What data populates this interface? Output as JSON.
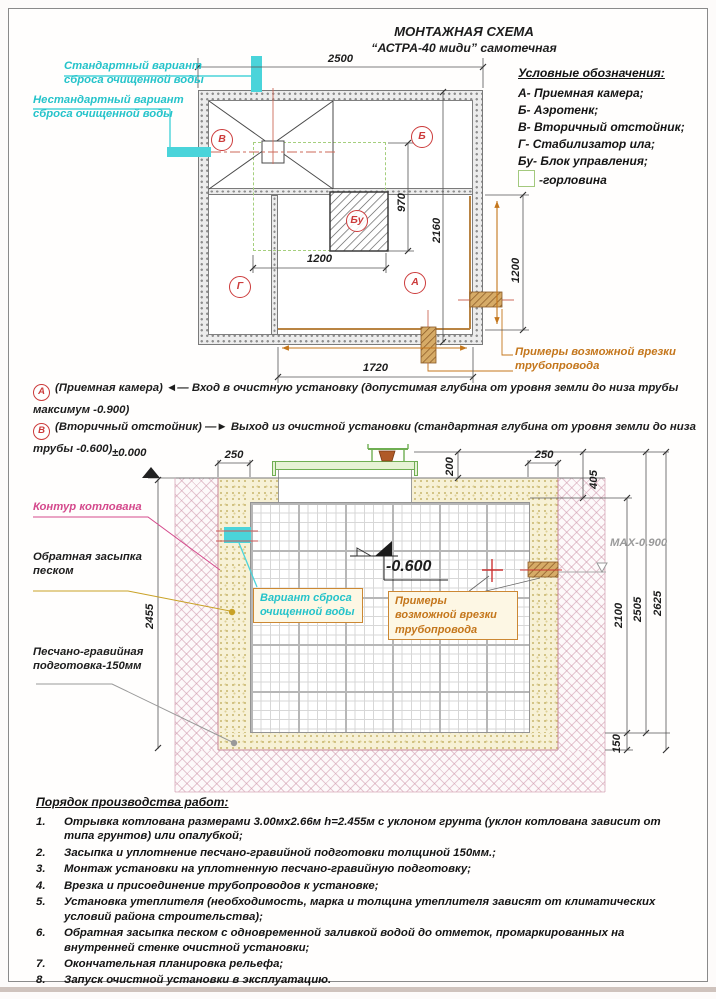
{
  "page": {
    "title_line1": "МОНТАЖНАЯ СХЕМА",
    "title_line2": "“АСТРА-40 миди” самотечная"
  },
  "legend": {
    "title": "Условные обозначения:",
    "items": [
      {
        "key": "А-",
        "label": "Приемная камера;"
      },
      {
        "key": "Б-",
        "label": "Аэротенк;"
      },
      {
        "key": "В-",
        "label": "Вторичный отстойник;"
      },
      {
        "key": "Г-",
        "label": "Стабилизатор ила;"
      },
      {
        "key": "Бу-",
        "label": "Блок управления;"
      }
    ],
    "neck": "-горловина"
  },
  "plan": {
    "discharge_standard": "Стандартный вариант сброса очищенной воды",
    "discharge_nonstandard": "Нестандартный вариант сброса очищенной воды",
    "pipe_examples": "Примеры возможной врезки трубопровода",
    "markers": {
      "v": "В",
      "b": "Б",
      "bu": "Бу",
      "g": "Г",
      "a": "А"
    },
    "dims": {
      "top_width": "2500",
      "right_height": "2160",
      "bu_width": "1200",
      "bu_height": "970",
      "bottom": "1720",
      "right_inlet": "1200"
    }
  },
  "notes": {
    "a": {
      "marker": "А",
      "name": "(Приемная камера)",
      "arrow": "◄—",
      "text": "Вход в очистную установку (допустимая глубина от уровня земли до низа трубы",
      "text2": "максимум -0.900)"
    },
    "b": {
      "marker": "В",
      "name": "(Вторичный отстойник)",
      "arrow": "—►",
      "text": "Выход из очистной установки (стандартная глубина от уровня земли до низа",
      "text2": "трубы -0.600)"
    }
  },
  "section": {
    "levels": {
      "zero": "±0.000",
      "minus600": "-0.600",
      "max900": "MAX-0.900"
    },
    "dims": {
      "backfill_left": "250",
      "lid": "200",
      "backfill_right": "250",
      "top": "405",
      "body": "2100",
      "mid": "2505",
      "total": "2625",
      "bed": "150",
      "depth": "2455"
    },
    "labels": {
      "contour": "Контур котлована",
      "backfill": "Обратная засыпка песком",
      "discharge_variant": "Вариант сброса очищенной воды",
      "pipe_examples": "Примеры возможной врезки трубопровода",
      "bed": "Песчано-гравийная подготовка-150мм"
    }
  },
  "procedure": {
    "title": "Порядок производства работ:",
    "items": [
      {
        "num": "1.",
        "text": "Отрывка котлована размерами 3.00мх2.66м h=2.455м с уклоном грунта (уклон котлована зависит от типа грунтов) или опалубкой;"
      },
      {
        "num": "2.",
        "text": "Засыпка и уплотнение песчано-гравийной подготовки толщиной 150мм.;"
      },
      {
        "num": "3.",
        "text": "Монтаж установки на уплотненную песчано-гравийную подготовку;"
      },
      {
        "num": "4.",
        "text": "Врезка и присоединение трубопроводов к установке;"
      },
      {
        "num": "5.",
        "text": "Установка утеплителя (необходимость, марка и толщина утеплителя зависят от климатических условий района строительства);"
      },
      {
        "num": "6.",
        "text": "Обратная засыпка песком с одновременной заливкой водой до отметок, промаркированных на внутренней стенке очистной установки;"
      },
      {
        "num": "7.",
        "text": "Окончательная планировка рельефа;"
      },
      {
        "num": "8.",
        "text": "Запуск очистной установки в эксплуатацию."
      }
    ]
  },
  "colors": {
    "cyan": "#25c3ca",
    "red": "#cc3b3b",
    "orange": "#c4761b",
    "green": "#6fae52",
    "pink": "#d4498c"
  }
}
